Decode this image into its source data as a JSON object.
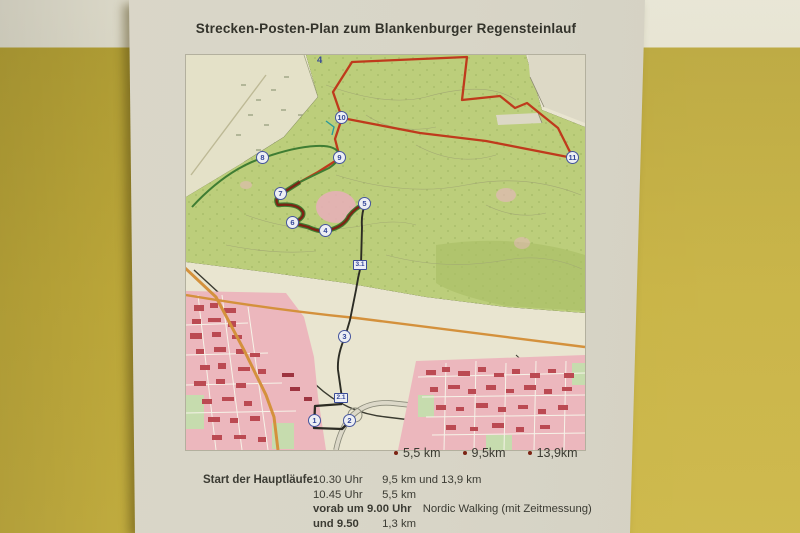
{
  "poster": {
    "title": "Strecken-Posten-Plan zum Blankenburger Regensteinlauf"
  },
  "map": {
    "description": "Topographic course map of Blankenburg with Regenstein running routes",
    "grid_label": "4",
    "checkpoints": [
      {
        "label": "1"
      },
      {
        "label": "2"
      },
      {
        "label": "3"
      },
      {
        "label": "4"
      },
      {
        "label": "5"
      },
      {
        "label": "6"
      },
      {
        "label": "7"
      },
      {
        "label": "8"
      },
      {
        "label": "9"
      },
      {
        "label": "10"
      },
      {
        "label": "11"
      }
    ],
    "distance_markers": [
      {
        "label": "3.1"
      },
      {
        "label": "2.1"
      }
    ]
  },
  "legend": {
    "items": [
      {
        "label": "5,5 km"
      },
      {
        "label": "9,5km"
      },
      {
        "label": "13,9km"
      }
    ]
  },
  "start_info": {
    "heading": "Start der Hauptläufe:",
    "rows": [
      {
        "time": "10.30 Uhr",
        "detail": "9,5 km und 13,9  km"
      },
      {
        "time": "10.45 Uhr",
        "detail": "5,5 km"
      },
      {
        "time": "vorab um 9.00 Uhr",
        "detail": "Nordic Walking (mit Zeitmessung)"
      },
      {
        "time": "und 9.50",
        "detail": "1,3 km"
      }
    ]
  },
  "colors": {
    "wall_yellow": "#c6b03c",
    "wall_stripe": "#e7e4d3",
    "paper": "#d8d5c7",
    "route_long_red": "#bf3a1c",
    "route_medium_green": "#3f7d33",
    "route_connector_black": "#2c2c24",
    "legend_dot": "#7c2414",
    "forest_green": "#bccе7b",
    "town_pink": "#ecb7bd"
  }
}
